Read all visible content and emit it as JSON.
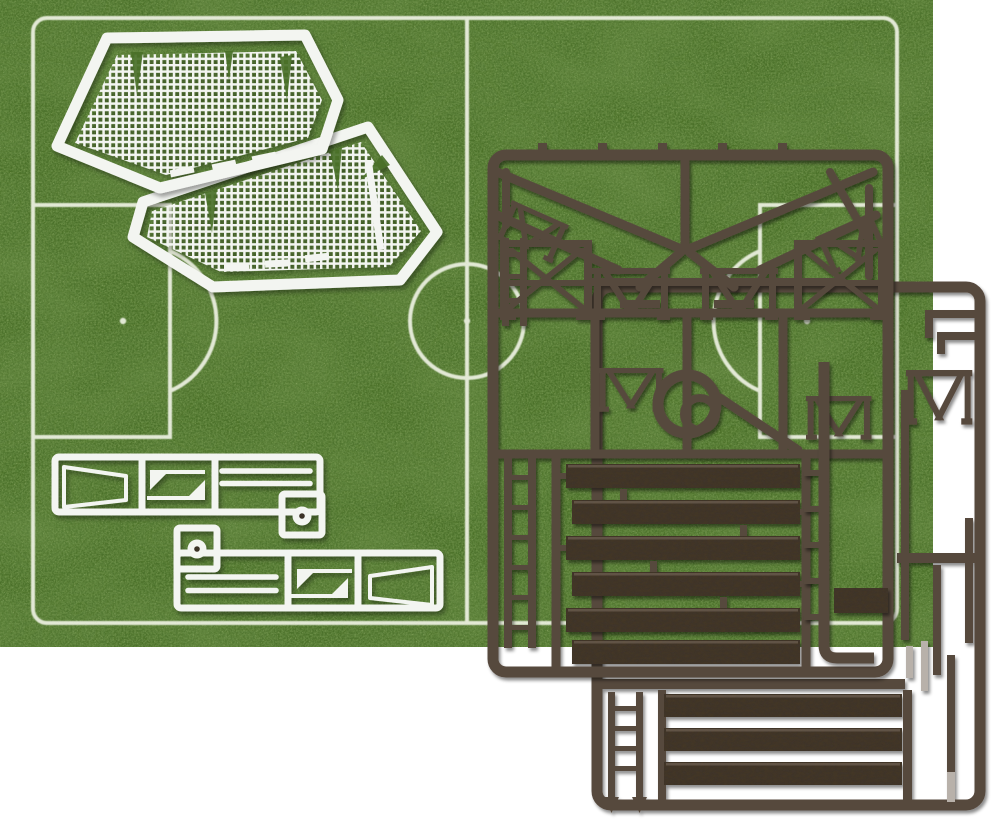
{
  "scene": {
    "description": "Overhead photo of a football stadium model kit: two white hexagonal goal-net mesh sprues and two white accessory sprues lying on a printed grass pitch mat, with two dark brown grandstand and fence sprues overlapping the right side",
    "background_color": "#ffffff"
  },
  "pitch_mat": {
    "grass_base_color": "#4a7029",
    "grass_patch_color": "#24420f",
    "grass_dark_speckle_color": "#2a4a12",
    "grass_light_speckle_color": "#94ae55",
    "line_color": "#edf1e2",
    "markings": [
      "boundary",
      "halfway-line",
      "center-circle",
      "center-spot",
      "left-penalty-area",
      "left-penalty-arc",
      "left-penalty-spot",
      "right-penalty-area",
      "right-penalty-arc",
      "right-penalty-spot",
      "corner-arcs"
    ]
  },
  "white_sprues": {
    "color": "#f3f5f1",
    "net_panel_count": 2,
    "net_panel_description": "hexagonal folded goal-net mesh panels",
    "accessory_sprue_count": 2,
    "accessory_parts": [
      "tapered goal side",
      "corner flag",
      "corner flag",
      "goal bar",
      "goal bar",
      "flag base disc"
    ],
    "flag_dot_color": "#3a3128"
  },
  "dark_sprues": {
    "color": "#57493e",
    "plank_color": "#40342b",
    "plank_highlight_color": "#8a796b",
    "light_part_color": "#b8b1aa",
    "sprue_count": 2,
    "front_sprue_parts": [
      "chevron runners",
      "crowd-barrier trusses",
      "ring part",
      "ladder strips",
      "terrace planks"
    ],
    "rear_sprue_parts": [
      "truss sections",
      "rails",
      "ladder with pointed feet",
      "terrace planks",
      "posts"
    ],
    "front_plank_count": 6,
    "rear_plank_count": 3
  }
}
